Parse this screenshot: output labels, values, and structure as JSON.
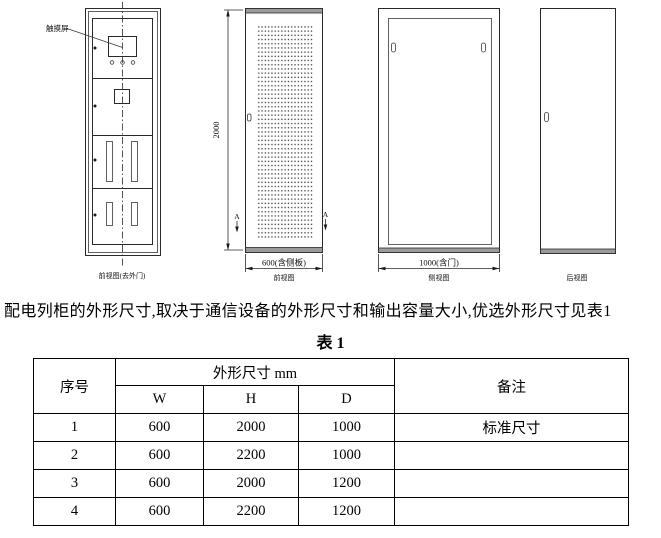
{
  "drawings": {
    "view1": {
      "caption": "前视图(去外门)",
      "touchscreen_label": "触摸屏"
    },
    "view2": {
      "caption": "前视图",
      "height_dim": "2000",
      "width_dim": "600(含侧板)",
      "section_marker_left": "A",
      "section_marker_right": "A"
    },
    "view3": {
      "caption": "侧视图",
      "width_dim": "1000(含门)"
    },
    "view4": {
      "caption": "后视图"
    }
  },
  "paragraph": "配电列柜的外形尺寸,取决于通信设备的外形尺寸和输出容量大小,优选外形尺寸见表1",
  "table": {
    "title": "表 1",
    "header": {
      "no": "序号",
      "dims": "外形尺寸 mm",
      "w": "W",
      "h": "H",
      "d": "D",
      "remark": "备注"
    },
    "rows": [
      {
        "no": "1",
        "w": "600",
        "h": "2000",
        "d": "1000",
        "remark": "标准尺寸"
      },
      {
        "no": "2",
        "w": "600",
        "h": "2200",
        "d": "1000",
        "remark": ""
      },
      {
        "no": "3",
        "w": "600",
        "h": "2000",
        "d": "1200",
        "remark": ""
      },
      {
        "no": "4",
        "w": "600",
        "h": "2200",
        "d": "1200",
        "remark": ""
      }
    ]
  }
}
